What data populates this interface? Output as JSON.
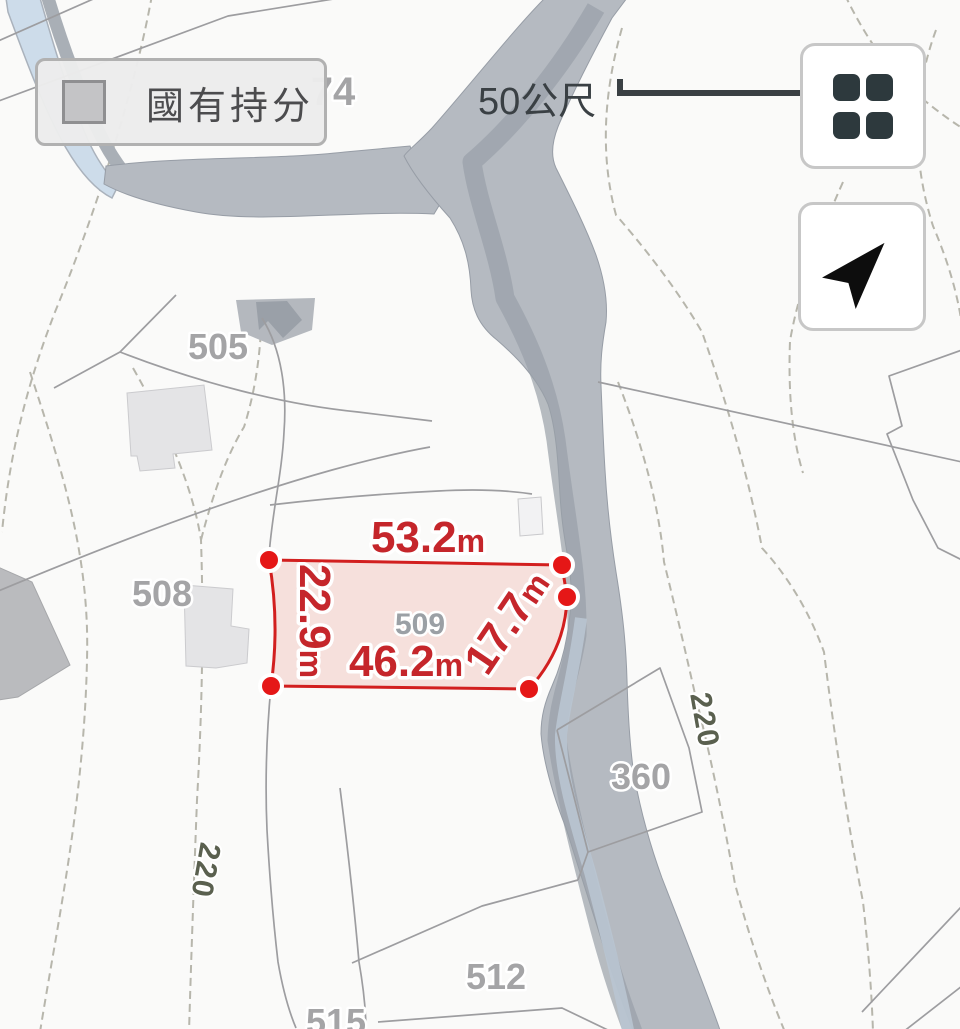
{
  "legend": {
    "label": "國有持分",
    "swatch_color": "#c4c4c6"
  },
  "scale_bar": {
    "label": "50公尺"
  },
  "buttons": {
    "grid": {
      "icon": "grid-icon"
    },
    "locate": {
      "icon": "navigation-arrow-icon"
    }
  },
  "map": {
    "parcels": [
      {
        "id": "74"
      },
      {
        "id": "505"
      },
      {
        "id": "508"
      },
      {
        "id": "509"
      },
      {
        "id": "512"
      },
      {
        "id": "515"
      },
      {
        "id": "360"
      }
    ],
    "contours": [
      {
        "label": "220"
      },
      {
        "label": "220"
      }
    ],
    "highlight": {
      "parcel_id": "509",
      "stroke_color": "#d21f1f",
      "fill_color": "rgba(226,74,52,0.14)",
      "measurements": [
        {
          "value": "53.2",
          "unit": "m"
        },
        {
          "value": "22.9",
          "unit": "m"
        },
        {
          "value": "46.2",
          "unit": "m"
        },
        {
          "value": "17.7",
          "unit": "m"
        }
      ]
    },
    "colors": {
      "river": "#b5bac1",
      "contour_line": "#b7b6ac",
      "contour_label": "#5a604f",
      "parcel_label": "#a4a4a6",
      "boundary_line": "#9d9da0"
    }
  }
}
